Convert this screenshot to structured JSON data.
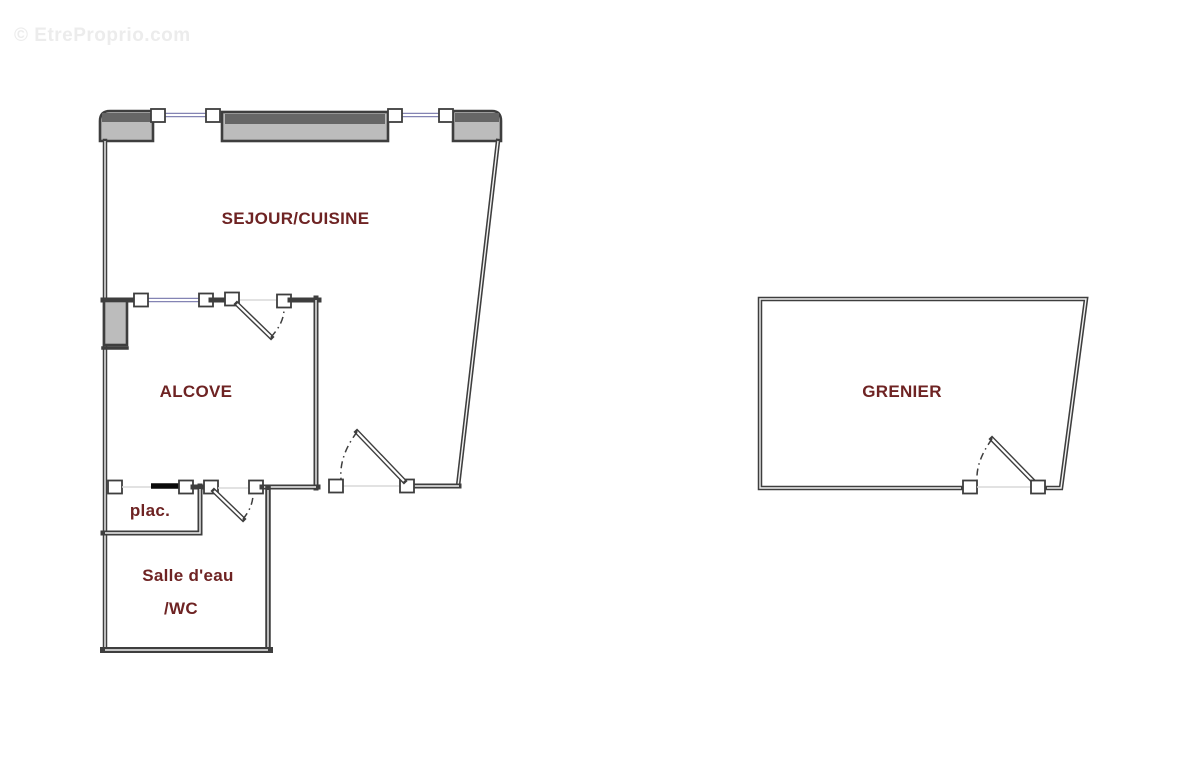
{
  "watermark": {
    "text": "© EtreProprio.com"
  },
  "colors": {
    "background": "#ffffff",
    "wall_dark": "#3e3e3e",
    "wall_core": "#f2f2f2",
    "block_fill": "#bcbcbc",
    "block_band": "#666666",
    "window_line": "#8484b4",
    "opening_line": "#d9d9d9",
    "door_black": "#0a0a0a",
    "label_text": "#6e2323",
    "watermark_text": "#ececec"
  },
  "floorplan": {
    "type": "floor-plan",
    "rooms": {
      "sejour": {
        "label": "SEJOUR/CUISINE"
      },
      "alcove": {
        "label": "ALCOVE"
      },
      "placard": {
        "label": "plac."
      },
      "salle_eau": {
        "label": "Salle d'eau"
      },
      "wc": {
        "label": "/WC"
      },
      "grenier": {
        "label": "GRENIER"
      }
    }
  }
}
